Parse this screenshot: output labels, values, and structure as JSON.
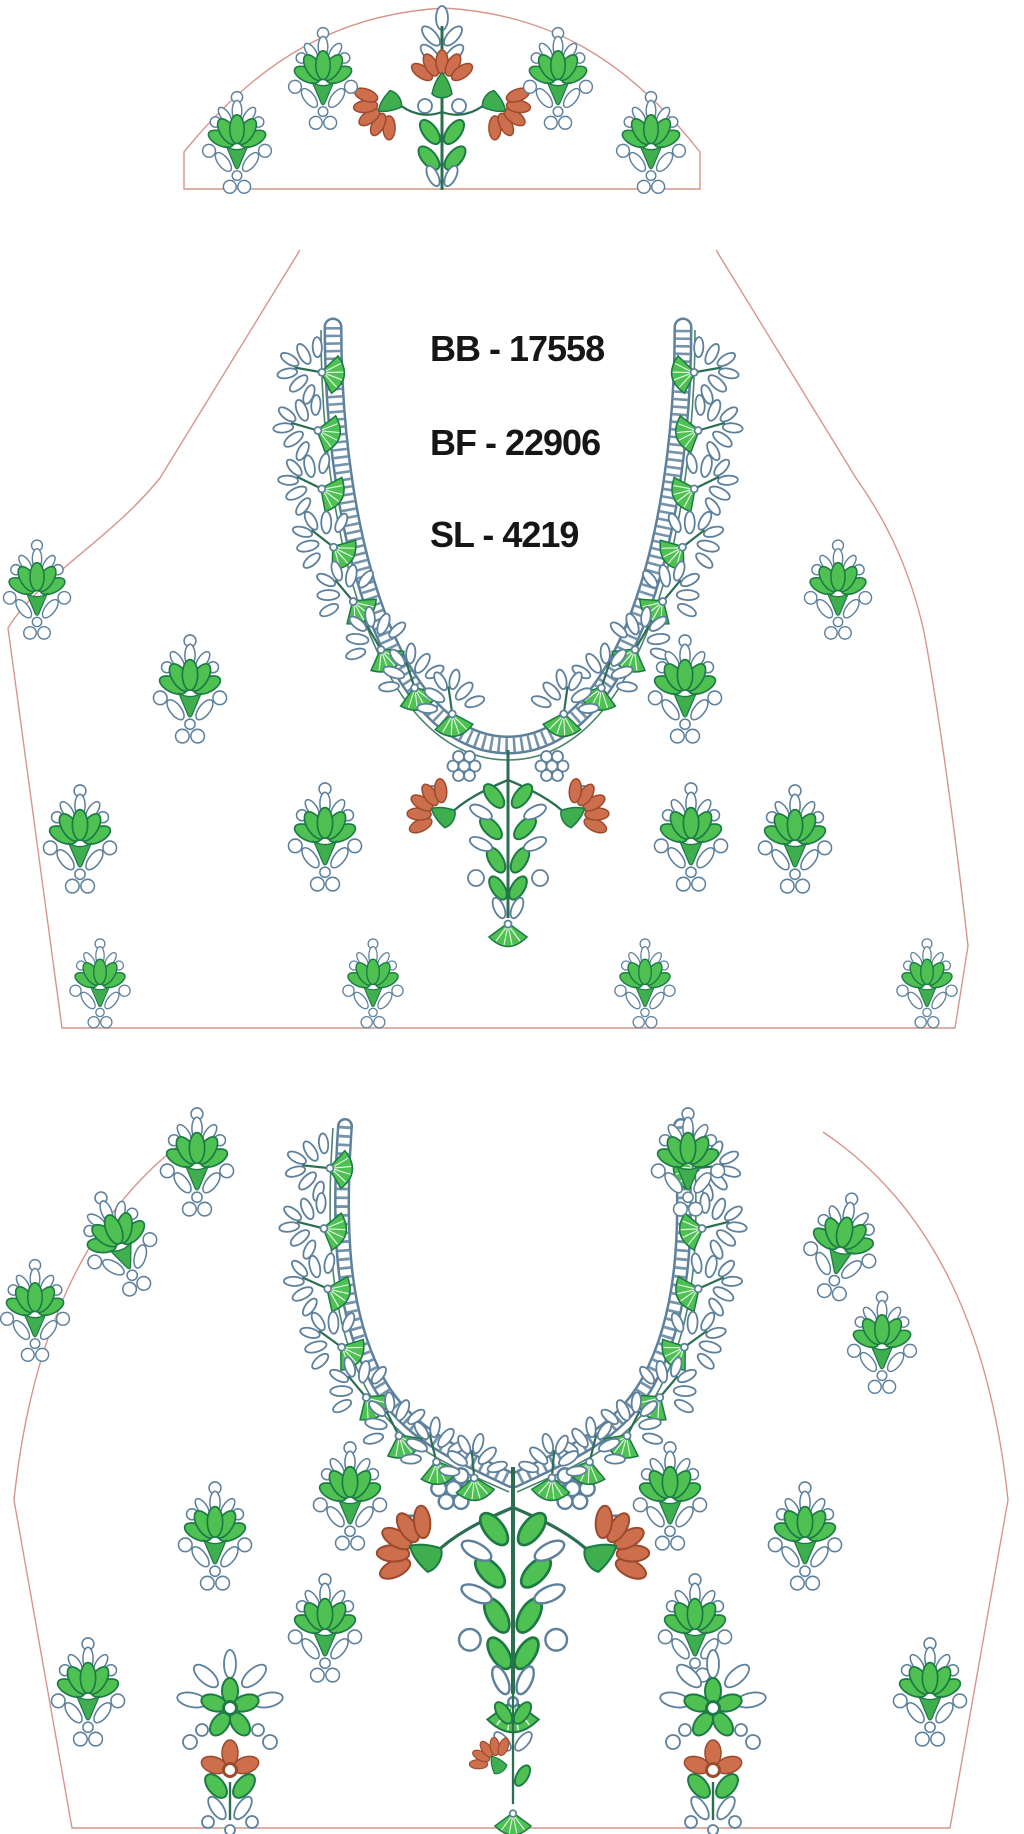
{
  "labels": {
    "bb": "BB - 17558",
    "bf": "BF - 22906",
    "sl": "SL - 4219"
  },
  "colors": {
    "green": "#4ec152",
    "green_shade": "#3fae4e",
    "green_dark": "#1d7a46",
    "orange": "#cd6f4c",
    "orange_dark": "#9c4a2e",
    "steel_blue": "#5d809c",
    "stem_green": "#2c6e52",
    "pattern_outline_salmon": "#d6958c",
    "text": "#161616",
    "background": "#ffffff"
  },
  "design": {
    "sleeve": {
      "motifs": [
        {
          "t": "sleevespray",
          "x": 442,
          "y": 8,
          "s": 1,
          "r": 0
        },
        {
          "t": "buti",
          "x": 323,
          "y": 86,
          "s": 0.8,
          "r": 0
        },
        {
          "t": "buti",
          "x": 558,
          "y": 86,
          "s": 0.8,
          "r": 0
        },
        {
          "t": "buti",
          "x": 237,
          "y": 150,
          "s": 0.8,
          "r": 0
        },
        {
          "t": "buti",
          "x": 651,
          "y": 150,
          "s": 0.8,
          "r": 0
        }
      ]
    },
    "back": {
      "motifs": [
        {
          "t": "pendant",
          "x": 508,
          "y": 770,
          "s": 1,
          "r": 0
        },
        {
          "t": "fanspray",
          "x": 320,
          "y": 372,
          "s": 1,
          "r": -80
        },
        {
          "t": "fanspray",
          "x": 316,
          "y": 430,
          "s": 1,
          "r": -74
        },
        {
          "t": "fanspray",
          "x": 320,
          "y": 488,
          "s": 1,
          "r": -64
        },
        {
          "t": "fanspray",
          "x": 332,
          "y": 546,
          "s": 1,
          "r": -52
        },
        {
          "t": "fanspray",
          "x": 352,
          "y": 600,
          "s": 1,
          "r": -40
        },
        {
          "t": "fanspray",
          "x": 380,
          "y": 648,
          "s": 1,
          "r": -30
        },
        {
          "t": "fanspray",
          "x": 414,
          "y": 686,
          "s": 1,
          "r": -18
        },
        {
          "t": "fanspray",
          "x": 452,
          "y": 712,
          "s": 1,
          "r": -8
        },
        {
          "t": "fanspray",
          "x": 696,
          "y": 372,
          "s": 1,
          "r": 80
        },
        {
          "t": "fanspray",
          "x": 700,
          "y": 430,
          "s": 1,
          "r": 74
        },
        {
          "t": "fanspray",
          "x": 696,
          "y": 488,
          "s": 1,
          "r": 64
        },
        {
          "t": "fanspray",
          "x": 684,
          "y": 546,
          "s": 1,
          "r": 52
        },
        {
          "t": "fanspray",
          "x": 664,
          "y": 600,
          "s": 1,
          "r": 40
        },
        {
          "t": "fanspray",
          "x": 636,
          "y": 648,
          "s": 1,
          "r": 30
        },
        {
          "t": "fanspray",
          "x": 602,
          "y": 686,
          "s": 1,
          "r": 18
        },
        {
          "t": "fanspray",
          "x": 564,
          "y": 712,
          "s": 1,
          "r": 8
        },
        {
          "t": "buti",
          "x": 37,
          "y": 597,
          "s": 0.78,
          "r": 0
        },
        {
          "t": "buti",
          "x": 838,
          "y": 597,
          "s": 0.78,
          "r": 0
        },
        {
          "t": "buti",
          "x": 190,
          "y": 697,
          "s": 0.85,
          "r": 0
        },
        {
          "t": "buti",
          "x": 685,
          "y": 697,
          "s": 0.85,
          "r": 0
        },
        {
          "t": "buti",
          "x": 80,
          "y": 847,
          "s": 0.85,
          "r": 0
        },
        {
          "t": "buti",
          "x": 325,
          "y": 845,
          "s": 0.85,
          "r": 0
        },
        {
          "t": "buti",
          "x": 691,
          "y": 845,
          "s": 0.85,
          "r": 0
        },
        {
          "t": "buti",
          "x": 795,
          "y": 847,
          "s": 0.85,
          "r": 0
        },
        {
          "t": "buti",
          "x": 100,
          "y": 990,
          "s": 0.7,
          "r": 0
        },
        {
          "t": "buti",
          "x": 373,
          "y": 990,
          "s": 0.7,
          "r": 0
        },
        {
          "t": "buti",
          "x": 645,
          "y": 990,
          "s": 0.7,
          "r": 0
        },
        {
          "t": "buti",
          "x": 927,
          "y": 990,
          "s": 0.7,
          "r": 0
        }
      ]
    },
    "front": {
      "motifs": [
        {
          "t": "pendant",
          "x": 513,
          "y": 1494,
          "s": 1.35,
          "r": 0
        },
        {
          "t": "tailspray",
          "x": 513,
          "y": 1692,
          "s": 0.95,
          "r": 0
        },
        {
          "t": "fanspray",
          "x": 328,
          "y": 1168,
          "s": 1,
          "r": -84
        },
        {
          "t": "fanspray",
          "x": 322,
          "y": 1228,
          "s": 1,
          "r": -76
        },
        {
          "t": "fanspray",
          "x": 326,
          "y": 1288,
          "s": 1,
          "r": -66
        },
        {
          "t": "fanspray",
          "x": 340,
          "y": 1346,
          "s": 1,
          "r": -54
        },
        {
          "t": "fanspray",
          "x": 365,
          "y": 1396,
          "s": 1,
          "r": -40
        },
        {
          "t": "fanspray",
          "x": 398,
          "y": 1434,
          "s": 1,
          "r": -27
        },
        {
          "t": "fanspray",
          "x": 436,
          "y": 1460,
          "s": 1,
          "r": -14
        },
        {
          "t": "fanspray",
          "x": 474,
          "y": 1476,
          "s": 1,
          "r": -5
        },
        {
          "t": "fanspray",
          "x": 698,
          "y": 1168,
          "s": 1,
          "r": 84
        },
        {
          "t": "fanspray",
          "x": 704,
          "y": 1228,
          "s": 1,
          "r": 76
        },
        {
          "t": "fanspray",
          "x": 700,
          "y": 1288,
          "s": 1,
          "r": 66
        },
        {
          "t": "fanspray",
          "x": 686,
          "y": 1346,
          "s": 1,
          "r": 54
        },
        {
          "t": "fanspray",
          "x": 661,
          "y": 1396,
          "s": 1,
          "r": 40
        },
        {
          "t": "fanspray",
          "x": 628,
          "y": 1434,
          "s": 1,
          "r": 27
        },
        {
          "t": "fanspray",
          "x": 590,
          "y": 1460,
          "s": 1,
          "r": 14
        },
        {
          "t": "fanspray",
          "x": 552,
          "y": 1476,
          "s": 1,
          "r": 5
        },
        {
          "t": "buti",
          "x": 197,
          "y": 1170,
          "s": 0.85,
          "r": 0
        },
        {
          "t": "buti",
          "x": 688,
          "y": 1170,
          "s": 0.85,
          "r": 0
        },
        {
          "t": "buti",
          "x": 122,
          "y": 1250,
          "s": 0.85,
          "r": -22
        },
        {
          "t": "buti",
          "x": 840,
          "y": 1254,
          "s": 0.85,
          "r": 12
        },
        {
          "t": "buti",
          "x": 35,
          "y": 1318,
          "s": 0.8,
          "r": 0
        },
        {
          "t": "buti",
          "x": 882,
          "y": 1350,
          "s": 0.8,
          "r": 0
        },
        {
          "t": "buti",
          "x": 350,
          "y": 1504,
          "s": 0.85,
          "r": 0
        },
        {
          "t": "buti",
          "x": 670,
          "y": 1504,
          "s": 0.85,
          "r": 0
        },
        {
          "t": "buti",
          "x": 215,
          "y": 1544,
          "s": 0.85,
          "r": 0
        },
        {
          "t": "buti",
          "x": 805,
          "y": 1544,
          "s": 0.85,
          "r": 0
        },
        {
          "t": "buti",
          "x": 325,
          "y": 1636,
          "s": 0.85,
          "r": 0
        },
        {
          "t": "buti",
          "x": 695,
          "y": 1636,
          "s": 0.85,
          "r": 0
        },
        {
          "t": "buti",
          "x": 88,
          "y": 1700,
          "s": 0.85,
          "r": 0
        },
        {
          "t": "buti",
          "x": 930,
          "y": 1700,
          "s": 0.85,
          "r": 0
        },
        {
          "t": "hemflower",
          "x": 230,
          "y": 1748,
          "s": 1,
          "r": 0
        },
        {
          "t": "hemflower",
          "x": 713,
          "y": 1748,
          "s": 1,
          "r": 0
        }
      ]
    }
  }
}
